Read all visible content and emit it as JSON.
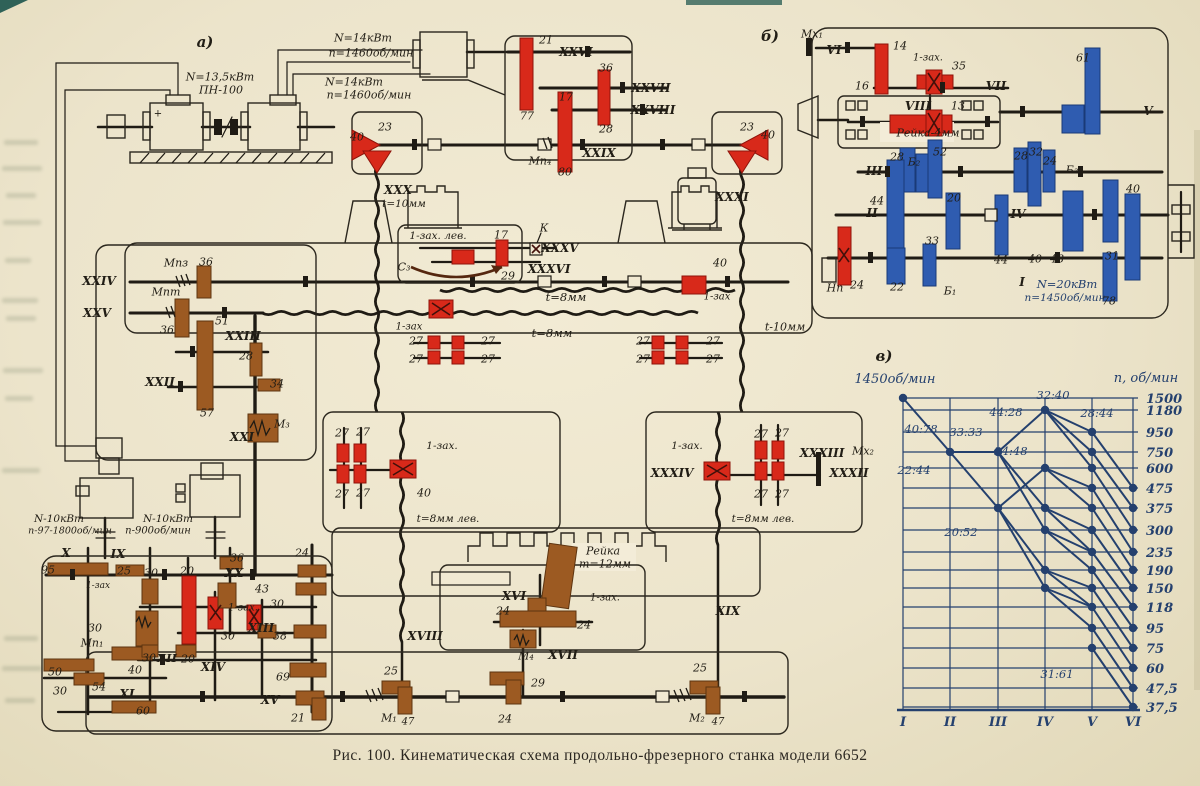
{
  "figure": {
    "caption": "Рис. 100. Кинематическая схема продольно-фрезерного станка модели 6652"
  },
  "colors": {
    "paper": "#ece4cb",
    "ink": "#1f1b14",
    "red": "#d8291a",
    "brown": "#9c5a22",
    "blue": "#2f5cb0",
    "chart_ink": "#24406e"
  },
  "labels": [
    {
      "t": "а)",
      "x": 205,
      "y": 42,
      "s": 15,
      "c": "r"
    },
    {
      "t": "N=13,5кВт",
      "x": 220,
      "y": 77
    },
    {
      "t": "ПН-100",
      "x": 221,
      "y": 90
    },
    {
      "t": "N=14кВт",
      "x": 363,
      "y": 38
    },
    {
      "t": "n=1460об/мин",
      "x": 371,
      "y": 53
    },
    {
      "t": "N=14кВт",
      "x": 354,
      "y": 82
    },
    {
      "t": "n=1460об/мин",
      "x": 369,
      "y": 95
    },
    {
      "t": "+",
      "x": 158,
      "y": 114,
      "s": 10
    },
    {
      "t": "21",
      "x": 546,
      "y": 40
    },
    {
      "t": "XXVI",
      "x": 576,
      "y": 52,
      "s": 12,
      "c": "r"
    },
    {
      "t": "36",
      "x": 606,
      "y": 68
    },
    {
      "t": "77",
      "x": 527,
      "y": 116
    },
    {
      "t": "XXVII",
      "x": 651,
      "y": 88,
      "s": 12,
      "c": "r"
    },
    {
      "t": "17",
      "x": 566,
      "y": 97
    },
    {
      "t": "XXVIII",
      "x": 653,
      "y": 110,
      "s": 12,
      "c": "r"
    },
    {
      "t": "28",
      "x": 606,
      "y": 129
    },
    {
      "t": "Мп₄",
      "x": 540,
      "y": 161
    },
    {
      "t": "XXIX",
      "x": 599,
      "y": 153,
      "s": 12,
      "c": "r"
    },
    {
      "t": "80",
      "x": 565,
      "y": 172
    },
    {
      "t": "40",
      "x": 357,
      "y": 137
    },
    {
      "t": "23",
      "x": 385,
      "y": 127
    },
    {
      "t": "23",
      "x": 747,
      "y": 127
    },
    {
      "t": "40",
      "x": 768,
      "y": 135
    },
    {
      "t": "XXX",
      "x": 398,
      "y": 190,
      "s": 12,
      "c": "r"
    },
    {
      "t": "t=10мм",
      "x": 404,
      "y": 204,
      "s": 10.5
    },
    {
      "t": "XXXI",
      "x": 732,
      "y": 197,
      "s": 12,
      "c": "r"
    },
    {
      "t": "XXIV",
      "x": 99,
      "y": 281,
      "s": 12,
      "c": "r"
    },
    {
      "t": "Мпз",
      "x": 176,
      "y": 263
    },
    {
      "t": "36",
      "x": 206,
      "y": 262
    },
    {
      "t": "Мпт",
      "x": 166,
      "y": 292
    },
    {
      "t": "XXV",
      "x": 97,
      "y": 313,
      "s": 12,
      "c": "r"
    },
    {
      "t": "36",
      "x": 167,
      "y": 330
    },
    {
      "t": "51",
      "x": 222,
      "y": 321
    },
    {
      "t": "XXIII",
      "x": 243,
      "y": 336,
      "s": 12,
      "c": "r"
    },
    {
      "t": "28",
      "x": 246,
      "y": 356
    },
    {
      "t": "XXII",
      "x": 160,
      "y": 382,
      "s": 12,
      "c": "r"
    },
    {
      "t": "34",
      "x": 277,
      "y": 384
    },
    {
      "t": "57",
      "x": 207,
      "y": 413
    },
    {
      "t": "М₃",
      "x": 282,
      "y": 424
    },
    {
      "t": "XXI",
      "x": 242,
      "y": 437,
      "s": 12,
      "c": "r"
    },
    {
      "t": "1-зах. лев.",
      "x": 438,
      "y": 236,
      "s": 10.5
    },
    {
      "t": "17",
      "x": 501,
      "y": 235
    },
    {
      "t": "К",
      "x": 544,
      "y": 228
    },
    {
      "t": "XXXV",
      "x": 560,
      "y": 248,
      "s": 12,
      "c": "r"
    },
    {
      "t": "С₃",
      "x": 404,
      "y": 267
    },
    {
      "t": "XXXVI",
      "x": 549,
      "y": 269,
      "s": 12,
      "c": "r"
    },
    {
      "t": "29",
      "x": 508,
      "y": 276
    },
    {
      "t": "t=8мм",
      "x": 566,
      "y": 297,
      "s": 11.5
    },
    {
      "t": "t=8мм",
      "x": 552,
      "y": 333,
      "s": 11.5
    },
    {
      "t": "27",
      "x": 416,
      "y": 341
    },
    {
      "t": "27",
      "x": 488,
      "y": 341
    },
    {
      "t": "27",
      "x": 416,
      "y": 359
    },
    {
      "t": "27",
      "x": 488,
      "y": 359
    },
    {
      "t": "1-зах",
      "x": 409,
      "y": 327,
      "s": 10
    },
    {
      "t": "27",
      "x": 643,
      "y": 341
    },
    {
      "t": "27",
      "x": 713,
      "y": 341
    },
    {
      "t": "27",
      "x": 643,
      "y": 359
    },
    {
      "t": "27",
      "x": 713,
      "y": 359
    },
    {
      "t": "40",
      "x": 720,
      "y": 263
    },
    {
      "t": "1-зах",
      "x": 717,
      "y": 297,
      "s": 10
    },
    {
      "t": "t-10мм",
      "x": 785,
      "y": 327
    },
    {
      "t": "27",
      "x": 342,
      "y": 433
    },
    {
      "t": "27",
      "x": 363,
      "y": 432
    },
    {
      "t": "27",
      "x": 342,
      "y": 494
    },
    {
      "t": "27",
      "x": 363,
      "y": 493
    },
    {
      "t": "1-зах.",
      "x": 442,
      "y": 446,
      "s": 10.5
    },
    {
      "t": "40",
      "x": 424,
      "y": 493
    },
    {
      "t": "t=8мм лев.",
      "x": 448,
      "y": 519,
      "s": 10.5
    },
    {
      "t": "1-зах.",
      "x": 687,
      "y": 446,
      "s": 10.5
    },
    {
      "t": "XXXIV",
      "x": 672,
      "y": 473,
      "s": 12,
      "c": "r"
    },
    {
      "t": "27",
      "x": 761,
      "y": 434
    },
    {
      "t": "27",
      "x": 782,
      "y": 433
    },
    {
      "t": "27",
      "x": 761,
      "y": 494
    },
    {
      "t": "27",
      "x": 782,
      "y": 494
    },
    {
      "t": "XXXIII",
      "x": 822,
      "y": 453,
      "s": 12,
      "c": "r"
    },
    {
      "t": "Мх₂",
      "x": 863,
      "y": 451
    },
    {
      "t": "XXXII",
      "x": 849,
      "y": 473,
      "s": 12,
      "c": "r"
    },
    {
      "t": "t=8мм лев.",
      "x": 763,
      "y": 519,
      "s": 10.5
    },
    {
      "t": "N-10кВт",
      "x": 59,
      "y": 519,
      "s": 10.5
    },
    {
      "t": "п-97-1800об/мин",
      "x": 70,
      "y": 531,
      "s": 9.5
    },
    {
      "t": "N-10кВт",
      "x": 168,
      "y": 519,
      "s": 10.5
    },
    {
      "t": "п-900об/мин",
      "x": 158,
      "y": 531,
      "s": 10
    },
    {
      "t": "X",
      "x": 66,
      "y": 553,
      "s": 12,
      "c": "r"
    },
    {
      "t": "IX",
      "x": 118,
      "y": 554,
      "s": 12,
      "c": "r"
    },
    {
      "t": "95",
      "x": 48,
      "y": 570
    },
    {
      "t": "25",
      "x": 124,
      "y": 571
    },
    {
      "t": "1-зах",
      "x": 98,
      "y": 586,
      "s": 9
    },
    {
      "t": "30",
      "x": 151,
      "y": 573
    },
    {
      "t": "20",
      "x": 187,
      "y": 571
    },
    {
      "t": "36",
      "x": 237,
      "y": 558
    },
    {
      "t": "XX",
      "x": 234,
      "y": 573,
      "s": 12,
      "c": "r"
    },
    {
      "t": "24",
      "x": 302,
      "y": 553
    },
    {
      "t": "43",
      "x": 262,
      "y": 589
    },
    {
      "t": "1-зах.",
      "x": 243,
      "y": 608,
      "s": 10
    },
    {
      "t": "30",
      "x": 277,
      "y": 604
    },
    {
      "t": "30",
      "x": 95,
      "y": 628
    },
    {
      "t": "Мп₁",
      "x": 92,
      "y": 643
    },
    {
      "t": "30",
      "x": 149,
      "y": 658
    },
    {
      "t": "XII",
      "x": 167,
      "y": 658,
      "s": 11.5,
      "c": "r"
    },
    {
      "t": "20",
      "x": 188,
      "y": 659
    },
    {
      "t": "30",
      "x": 228,
      "y": 636
    },
    {
      "t": "XIII",
      "x": 261,
      "y": 628,
      "s": 12,
      "c": "r"
    },
    {
      "t": "38",
      "x": 280,
      "y": 636
    },
    {
      "t": "XIV",
      "x": 213,
      "y": 667,
      "s": 12,
      "c": "r"
    },
    {
      "t": "50",
      "x": 55,
      "y": 672
    },
    {
      "t": "40",
      "x": 135,
      "y": 670
    },
    {
      "t": "30",
      "x": 60,
      "y": 691
    },
    {
      "t": "54",
      "x": 99,
      "y": 687
    },
    {
      "t": "XI",
      "x": 127,
      "y": 694,
      "s": 12,
      "c": "r"
    },
    {
      "t": "60",
      "x": 143,
      "y": 711
    },
    {
      "t": "69",
      "x": 283,
      "y": 677
    },
    {
      "t": "XV",
      "x": 270,
      "y": 700,
      "s": 12,
      "c": "r"
    },
    {
      "t": "21",
      "x": 298,
      "y": 718
    },
    {
      "t": "Рейка",
      "x": 603,
      "y": 551
    },
    {
      "t": "m=12мм",
      "x": 605,
      "y": 564
    },
    {
      "t": "XVI",
      "x": 514,
      "y": 596,
      "s": 12,
      "c": "r"
    },
    {
      "t": "24",
      "x": 503,
      "y": 611
    },
    {
      "t": "1-зах.",
      "x": 605,
      "y": 598,
      "s": 10
    },
    {
      "t": "24",
      "x": 584,
      "y": 625
    },
    {
      "t": "М₄",
      "x": 526,
      "y": 656
    },
    {
      "t": "XVII",
      "x": 563,
      "y": 655,
      "s": 12,
      "c": "r"
    },
    {
      "t": "XVIII",
      "x": 425,
      "y": 636,
      "s": 12,
      "c": "r"
    },
    {
      "t": "25",
      "x": 391,
      "y": 671
    },
    {
      "t": "29",
      "x": 538,
      "y": 683
    },
    {
      "t": "М₁",
      "x": 389,
      "y": 718
    },
    {
      "t": "47",
      "x": 408,
      "y": 722,
      "s": 10
    },
    {
      "t": "24",
      "x": 505,
      "y": 719
    },
    {
      "t": "25",
      "x": 700,
      "y": 668
    },
    {
      "t": "XIX",
      "x": 728,
      "y": 611,
      "s": 12,
      "c": "r"
    },
    {
      "t": "М₂",
      "x": 697,
      "y": 718
    },
    {
      "t": "47",
      "x": 718,
      "y": 722,
      "s": 10
    },
    {
      "t": "б)",
      "x": 770,
      "y": 36,
      "s": 15,
      "c": "r"
    },
    {
      "t": "Мх₁",
      "x": 812,
      "y": 34
    },
    {
      "t": "VI",
      "x": 834,
      "y": 50,
      "s": 12,
      "c": "r"
    },
    {
      "t": "14",
      "x": 900,
      "y": 46
    },
    {
      "t": "1-зах.",
      "x": 928,
      "y": 58,
      "s": 10
    },
    {
      "t": "35",
      "x": 959,
      "y": 66
    },
    {
      "t": "16",
      "x": 862,
      "y": 86
    },
    {
      "t": "VII",
      "x": 996,
      "y": 86,
      "s": 12,
      "c": "r"
    },
    {
      "t": "VIII",
      "x": 918,
      "y": 106,
      "s": 12,
      "c": "r"
    },
    {
      "t": "13",
      "x": 958,
      "y": 106
    },
    {
      "t": "Рейка-4мм",
      "x": 928,
      "y": 133
    },
    {
      "t": "61",
      "x": 1083,
      "y": 58
    },
    {
      "t": "V",
      "x": 1148,
      "y": 111,
      "s": 12,
      "c": "r"
    },
    {
      "t": "III",
      "x": 874,
      "y": 171,
      "s": 12,
      "c": "r"
    },
    {
      "t": "28",
      "x": 897,
      "y": 157
    },
    {
      "t": "Б₂",
      "x": 914,
      "y": 162
    },
    {
      "t": "52",
      "x": 940,
      "y": 152
    },
    {
      "t": "28",
      "x": 1021,
      "y": 156
    },
    {
      "t": "32",
      "x": 1036,
      "y": 152
    },
    {
      "t": "24",
      "x": 1050,
      "y": 161
    },
    {
      "t": "Б₃",
      "x": 1072,
      "y": 170
    },
    {
      "t": "40",
      "x": 1133,
      "y": 189
    },
    {
      "t": "44",
      "x": 877,
      "y": 201
    },
    {
      "t": "II",
      "x": 872,
      "y": 213,
      "s": 12,
      "c": "r"
    },
    {
      "t": "20",
      "x": 954,
      "y": 198
    },
    {
      "t": "IV",
      "x": 1018,
      "y": 214,
      "s": 12,
      "c": "r"
    },
    {
      "t": "33",
      "x": 932,
      "y": 241
    },
    {
      "t": "44",
      "x": 1001,
      "y": 260
    },
    {
      "t": "40",
      "x": 1035,
      "y": 259
    },
    {
      "t": "48",
      "x": 1057,
      "y": 259
    },
    {
      "t": "31",
      "x": 1112,
      "y": 256
    },
    {
      "t": "22",
      "x": 897,
      "y": 287
    },
    {
      "t": "Б₁",
      "x": 950,
      "y": 291
    },
    {
      "t": "I",
      "x": 1022,
      "y": 282,
      "s": 12,
      "c": "r"
    },
    {
      "t": "N=20кВт",
      "x": 1067,
      "y": 284,
      "s": 11.5,
      "c": "b"
    },
    {
      "t": "п=1450об/мин",
      "x": 1065,
      "y": 298,
      "s": 10.5,
      "c": "b"
    },
    {
      "t": "78",
      "x": 1109,
      "y": 301
    },
    {
      "t": "Нп",
      "x": 835,
      "y": 288
    },
    {
      "t": "24",
      "x": 857,
      "y": 285
    },
    {
      "t": "в)",
      "x": 884,
      "y": 356,
      "s": 15,
      "c": "r"
    }
  ],
  "chart_data": {
    "type": "line",
    "variant": "speed-ray-diagram",
    "corner_label": "1450об/мин",
    "axis_label": "n, об/мин",
    "shafts": [
      "I",
      "II",
      "III",
      "IV",
      "V",
      "VI"
    ],
    "shaft_x": {
      "I": 903,
      "II": 950,
      "III": 998,
      "IV": 1045,
      "V": 1092,
      "VI": 1133
    },
    "speeds": [
      [
        "1500",
        1500,
        398
      ],
      [
        "1180",
        1180,
        410
      ],
      [
        "950",
        950,
        432
      ],
      [
        "750",
        750,
        452
      ],
      [
        "600",
        600,
        468
      ],
      [
        "475",
        475,
        488
      ],
      [
        "375",
        375,
        508
      ],
      [
        "300",
        300,
        530
      ],
      [
        "235",
        235,
        552
      ],
      [
        "190",
        190,
        570
      ],
      [
        "150",
        150,
        588
      ],
      [
        "118",
        118,
        607
      ],
      [
        "95",
        95,
        628
      ],
      [
        "75",
        75,
        648
      ],
      [
        "60",
        60,
        668
      ],
      [
        "47,5",
        47.5,
        688
      ],
      [
        "37,5",
        37.5,
        707
      ]
    ],
    "grid": {
      "x0": 903,
      "x1": 1138,
      "y_top": 398,
      "y_bottom": 710
    },
    "ratios": [
      [
        "40:78",
        921,
        433
      ],
      [
        "33:33",
        966,
        436
      ],
      [
        "44:28",
        1006,
        416
      ],
      [
        "32:40",
        1053,
        399
      ],
      [
        "28:44",
        1097,
        417
      ],
      [
        "24:48",
        1011,
        455
      ],
      [
        "22:44",
        914,
        474
      ],
      [
        "20:52",
        961,
        536
      ],
      [
        "31:61",
        1057,
        678
      ]
    ],
    "segments": [
      [
        "I",
        1500,
        "II",
        750
      ],
      [
        "II",
        750,
        "III",
        750
      ],
      [
        "II",
        750,
        "III",
        375
      ],
      [
        "III",
        750,
        "IV",
        1180
      ],
      [
        "III",
        750,
        "IV",
        375
      ],
      [
        "III",
        750,
        "IV",
        300
      ],
      [
        "III",
        375,
        "IV",
        600
      ],
      [
        "III",
        375,
        "IV",
        190
      ],
      [
        "III",
        375,
        "IV",
        150
      ],
      [
        "IV",
        1180,
        "V",
        950
      ],
      [
        "IV",
        1180,
        "V",
        750
      ],
      [
        "IV",
        1180,
        "V",
        600
      ],
      [
        "IV",
        600,
        "V",
        475
      ],
      [
        "IV",
        600,
        "V",
        375
      ],
      [
        "IV",
        375,
        "V",
        300
      ],
      [
        "IV",
        375,
        "V",
        235
      ],
      [
        "IV",
        300,
        "V",
        235
      ],
      [
        "IV",
        300,
        "V",
        190
      ],
      [
        "IV",
        190,
        "V",
        150
      ],
      [
        "IV",
        190,
        "V",
        118
      ],
      [
        "IV",
        150,
        "V",
        118
      ],
      [
        "IV",
        150,
        "V",
        95
      ],
      [
        "V",
        950,
        "VI",
        475
      ],
      [
        "V",
        750,
        "VI",
        375
      ],
      [
        "V",
        600,
        "VI",
        300
      ],
      [
        "V",
        475,
        "VI",
        235
      ],
      [
        "V",
        375,
        "VI",
        190
      ],
      [
        "V",
        300,
        "VI",
        150
      ],
      [
        "V",
        235,
        "VI",
        118
      ],
      [
        "V",
        190,
        "VI",
        95
      ],
      [
        "V",
        150,
        "VI",
        75
      ],
      [
        "V",
        118,
        "VI",
        60
      ],
      [
        "V",
        95,
        "VI",
        47.5
      ],
      [
        "V",
        75,
        "VI",
        37.5
      ]
    ]
  }
}
